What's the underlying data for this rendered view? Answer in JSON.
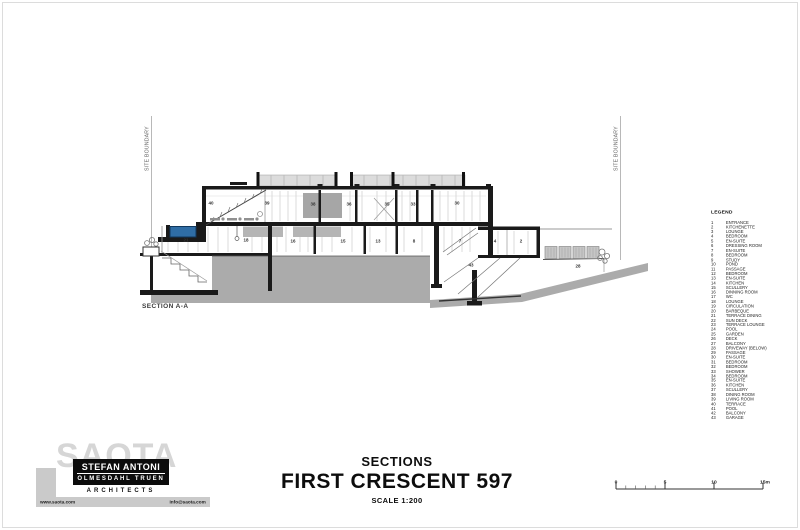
{
  "drawing": {
    "section_label": "SECTION A-A",
    "site_boundary_left": "SITE BOUNDARY",
    "site_boundary_right": "SITE BOUNDARY",
    "rooms": [
      {
        "n": "40",
        "x": 211,
        "y": 203
      },
      {
        "n": "39",
        "x": 267,
        "y": 203
      },
      {
        "n": "38",
        "x": 313,
        "y": 204
      },
      {
        "n": "36",
        "x": 349,
        "y": 204
      },
      {
        "n": "35",
        "x": 387,
        "y": 204
      },
      {
        "n": "33",
        "x": 413,
        "y": 204
      },
      {
        "n": "30",
        "x": 457,
        "y": 203
      },
      {
        "n": "21",
        "x": 186,
        "y": 240
      },
      {
        "n": "18",
        "x": 246,
        "y": 240
      },
      {
        "n": "16",
        "x": 293,
        "y": 241
      },
      {
        "n": "15",
        "x": 343,
        "y": 241
      },
      {
        "n": "13",
        "x": 378,
        "y": 241
      },
      {
        "n": "8",
        "x": 414,
        "y": 241
      },
      {
        "n": "7",
        "x": 460,
        "y": 241
      },
      {
        "n": "4",
        "x": 495,
        "y": 241
      },
      {
        "n": "2",
        "x": 521,
        "y": 241
      },
      {
        "n": "43",
        "x": 471,
        "y": 265
      },
      {
        "n": "28",
        "x": 578,
        "y": 266
      }
    ],
    "colors": {
      "ground": "#ababab",
      "pool": "#2f6da5",
      "clerestory_panel": "#dcdcdc",
      "structure": "#1a1a1a"
    }
  },
  "legend": {
    "heading": "LEGEND",
    "items": [
      [
        "1",
        "ENTRANCE"
      ],
      [
        "2",
        "KITCHENETTE"
      ],
      [
        "3",
        "LOUNGE"
      ],
      [
        "4",
        "BEDROOM"
      ],
      [
        "5",
        "EN-SUITE"
      ],
      [
        "6",
        "DRESSING ROOM"
      ],
      [
        "7",
        "EN-SUITE"
      ],
      [
        "8",
        "BEDROOM"
      ],
      [
        "9",
        "STUDY"
      ],
      [
        "10",
        "POND"
      ],
      [
        "11",
        "PASSAGE"
      ],
      [
        "12",
        "BEDROOM"
      ],
      [
        "13",
        "EN-SUITE"
      ],
      [
        "14",
        "KITCHEN"
      ],
      [
        "15",
        "SCULLERY"
      ],
      [
        "16",
        "DINNING ROOM"
      ],
      [
        "17",
        "WC"
      ],
      [
        "18",
        "LOUNGE"
      ],
      [
        "19",
        "CIRCULATION"
      ],
      [
        "20",
        "BARBEQUE"
      ],
      [
        "21",
        "TERRACE DINING"
      ],
      [
        "22",
        "SUN DECK"
      ],
      [
        "23",
        "TERRACE LOUNGE"
      ],
      [
        "24",
        "POOL"
      ],
      [
        "25",
        "GARDEN"
      ],
      [
        "26",
        "DECK"
      ],
      [
        "27",
        "BALCONY"
      ],
      [
        "28",
        "DRIVEWAY (BELOW)"
      ],
      [
        "29",
        "PASSAGE"
      ],
      [
        "30",
        "EN-SUITE"
      ],
      [
        "31",
        "BEDROOM"
      ],
      [
        "32",
        "BEDROOM"
      ],
      [
        "33",
        "SHOWER"
      ],
      [
        "34",
        "BEDROOM"
      ],
      [
        "35",
        "EN-SUITE"
      ],
      [
        "36",
        "KITCHEN"
      ],
      [
        "37",
        "SCULLERY"
      ],
      [
        "38",
        "DINING ROOM"
      ],
      [
        "39",
        "LIVING ROOM"
      ],
      [
        "40",
        "TERRACE"
      ],
      [
        "41",
        "POOL"
      ],
      [
        "42",
        "BALCONY"
      ],
      [
        "43",
        "GARAGE"
      ]
    ]
  },
  "title_block": {
    "subtitle": "SECTIONS",
    "title": "FIRST CRESCENT 597",
    "scale": "SCALE 1:200"
  },
  "logo": {
    "watermark": "SAOTA",
    "name_line1": "STEFAN ANTONI",
    "name_line2": "OLMESDAHL TRUEN",
    "name_line3": "ARCHITECTS",
    "website": "www.saota.com",
    "email": "info@saota.com"
  },
  "scale_bar": {
    "labels": [
      "0",
      "5",
      "10",
      "15m"
    ]
  }
}
